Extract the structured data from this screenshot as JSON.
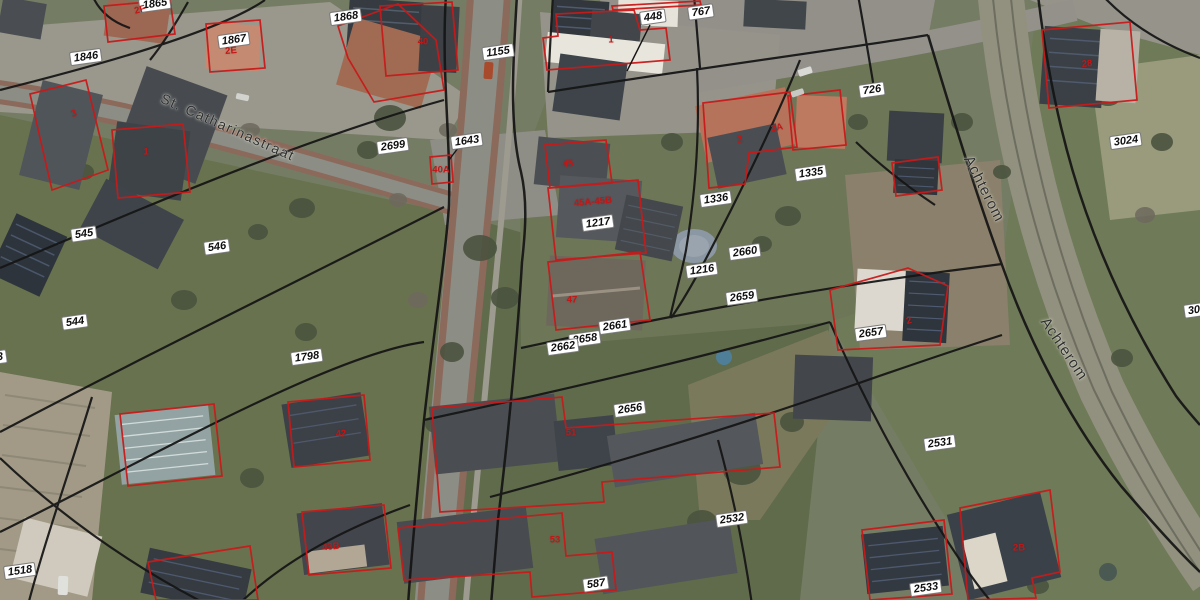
{
  "map": {
    "colors": {
      "badge_bg": "#ffffff",
      "badge_text": "#101010",
      "building_label": "#c41616",
      "building_outline": "#c81a1a",
      "parcel_line": "#151515",
      "road": "#8c8d85",
      "grass": "#68724f",
      "street_text": "#2e2e2e"
    },
    "street_labels": [
      {
        "text": "St. Catharinastraat",
        "x": 228,
        "y": 127,
        "rot": 24,
        "size": 14,
        "spacing": 1.5
      },
      {
        "text": "Achterom",
        "x": 984,
        "y": 189,
        "rot": 63,
        "size": 15,
        "spacing": 1
      },
      {
        "text": "Achterom",
        "x": 1064,
        "y": 349,
        "rot": 56,
        "size": 15,
        "spacing": 1
      }
    ],
    "parcel_labels": [
      {
        "text": "1865",
        "x": 155,
        "y": 4,
        "rot": -8
      },
      {
        "text": "1868",
        "x": 346,
        "y": 17,
        "rot": -8
      },
      {
        "text": "1867",
        "x": 234,
        "y": 40,
        "rot": -8
      },
      {
        "text": "1846",
        "x": 86,
        "y": 57,
        "rot": -8
      },
      {
        "text": "448",
        "x": 653,
        "y": 17,
        "rot": -8
      },
      {
        "text": "767",
        "x": 701,
        "y": 12,
        "rot": -8
      },
      {
        "text": "1155",
        "x": 498,
        "y": 52,
        "rot": -8
      },
      {
        "text": "2699",
        "x": 393,
        "y": 146,
        "rot": -8
      },
      {
        "text": "1643",
        "x": 467,
        "y": 141,
        "rot": -8
      },
      {
        "text": "726",
        "x": 872,
        "y": 90,
        "rot": -8
      },
      {
        "text": "3024",
        "x": 1126,
        "y": 141,
        "rot": -8
      },
      {
        "text": "1335",
        "x": 811,
        "y": 173,
        "rot": -8
      },
      {
        "text": "1336",
        "x": 716,
        "y": 199,
        "rot": -8
      },
      {
        "text": "1217",
        "x": 598,
        "y": 223,
        "rot": -8
      },
      {
        "text": "545",
        "x": 84,
        "y": 234,
        "rot": -8
      },
      {
        "text": "546",
        "x": 217,
        "y": 247,
        "rot": -8
      },
      {
        "text": "2660",
        "x": 745,
        "y": 252,
        "rot": -8
      },
      {
        "text": "1216",
        "x": 702,
        "y": 270,
        "rot": -8
      },
      {
        "text": "2659",
        "x": 742,
        "y": 297,
        "rot": -8
      },
      {
        "text": "544",
        "x": 75,
        "y": 322,
        "rot": -8
      },
      {
        "text": "2661",
        "x": 615,
        "y": 326,
        "rot": -8
      },
      {
        "text": "2658",
        "x": 585,
        "y": 339,
        "rot": -8
      },
      {
        "text": "2662",
        "x": 563,
        "y": 347,
        "rot": -8
      },
      {
        "text": "2657",
        "x": 871,
        "y": 333,
        "rot": -8
      },
      {
        "text": "1798",
        "x": 307,
        "y": 357,
        "rot": -8
      },
      {
        "text": "2656",
        "x": 630,
        "y": 409,
        "rot": -8
      },
      {
        "text": "2531",
        "x": 940,
        "y": 443,
        "rot": -8
      },
      {
        "text": "2532",
        "x": 732,
        "y": 519,
        "rot": -8
      },
      {
        "text": "587",
        "x": 596,
        "y": 584,
        "rot": -8
      },
      {
        "text": "2533",
        "x": 926,
        "y": 588,
        "rot": -8
      },
      {
        "text": "1518",
        "x": 20,
        "y": 571,
        "rot": -8
      },
      {
        "text": "3",
        "x": 0,
        "y": 357,
        "rot": -8
      },
      {
        "text": "302",
        "x": 1197,
        "y": 310,
        "rot": -8
      }
    ],
    "building_labels": [
      {
        "text": "2F",
        "x": 140,
        "y": 10,
        "rot": -15
      },
      {
        "text": "2E",
        "x": 231,
        "y": 51,
        "rot": -5
      },
      {
        "text": "3",
        "x": 74,
        "y": 114,
        "rot": -20
      },
      {
        "text": "1",
        "x": 146,
        "y": 152,
        "rot": 0
      },
      {
        "text": "40",
        "x": 423,
        "y": 42,
        "rot": 0
      },
      {
        "text": "1",
        "x": 611,
        "y": 40,
        "rot": 0
      },
      {
        "text": "45",
        "x": 568,
        "y": 164,
        "rot": -5
      },
      {
        "text": "45A-45B",
        "x": 593,
        "y": 202,
        "rot": -5
      },
      {
        "text": "2",
        "x": 740,
        "y": 140,
        "rot": -12
      },
      {
        "text": "2A",
        "x": 777,
        "y": 128,
        "rot": -12
      },
      {
        "text": "28",
        "x": 1087,
        "y": 64,
        "rot": -5
      },
      {
        "text": "47",
        "x": 572,
        "y": 300,
        "rot": 0
      },
      {
        "text": "40A",
        "x": 441,
        "y": 170,
        "rot": 0
      },
      {
        "text": "2",
        "x": 909,
        "y": 321,
        "rot": -15
      },
      {
        "text": "51",
        "x": 571,
        "y": 433,
        "rot": 0
      },
      {
        "text": "42",
        "x": 341,
        "y": 434,
        "rot": -5
      },
      {
        "text": "53",
        "x": 555,
        "y": 540,
        "rot": 0
      },
      {
        "text": "43B",
        "x": 331,
        "y": 547,
        "rot": -5
      },
      {
        "text": "2B",
        "x": 1019,
        "y": 548,
        "rot": 0
      }
    ]
  }
}
